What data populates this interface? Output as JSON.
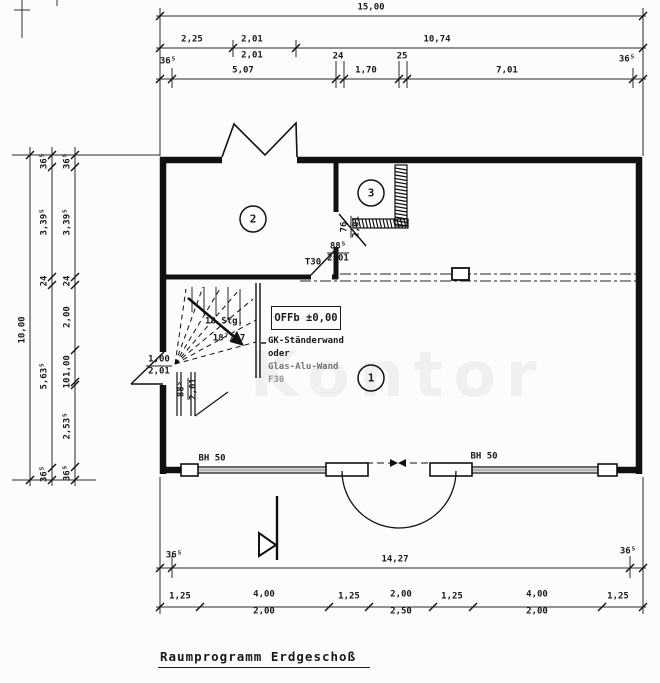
{
  "title": "Raumprogramm Erdgeschoß",
  "watermark": "Kontor",
  "plan": {
    "rooms": [
      {
        "number": "1"
      },
      {
        "number": "2"
      },
      {
        "number": "3"
      }
    ],
    "level_label": "OFFb ±0,00",
    "wall_note": {
      "line1": "GK-Ständerwand",
      "line2": "oder",
      "line3": "Glas-Alu-Wand",
      "line4": "F30"
    },
    "stairs": {
      "count": "18 Stg.",
      "ratio": "18⁷/27"
    },
    "doors": {
      "t30_label": "T30",
      "t30_size": {
        "w": "88⁵",
        "h": "2,01"
      },
      "entry": {
        "w": "1,00",
        "h": "2,01"
      },
      "room3": {
        "w": "76",
        "h": "2,01"
      },
      "vestibule": {
        "w": "88⁵",
        "h": "2,01"
      }
    },
    "windows": {
      "left_sill": "BH 50",
      "right_sill": "BH 50"
    }
  },
  "dimensions": {
    "top": {
      "total": "15,00",
      "row2": [
        "2,25",
        "2,01",
        "2,01",
        "10,74"
      ],
      "row3": [
        "36⁵",
        "5,07",
        "24",
        "1,70",
        "25",
        "7,01",
        "36⁵"
      ]
    },
    "left": {
      "total": "10,00",
      "chain_outer": [
        "36⁵",
        "3,39⁵",
        "24",
        "5,63⁵",
        "36⁵"
      ],
      "chain_inner": [
        "36⁵",
        "3,39⁵",
        "24",
        "2,00",
        "1,00",
        "10",
        "2,53⁵",
        "36⁵"
      ]
    },
    "bottom": {
      "row1": [
        "36⁵",
        "14,27",
        "36⁵"
      ],
      "row2": [
        "1,25",
        "4,00",
        "1,25",
        "2,00",
        "1,25",
        "4,00",
        "1,25"
      ],
      "row2_sub": [
        "2,00",
        "2,50",
        "2,00"
      ]
    }
  }
}
